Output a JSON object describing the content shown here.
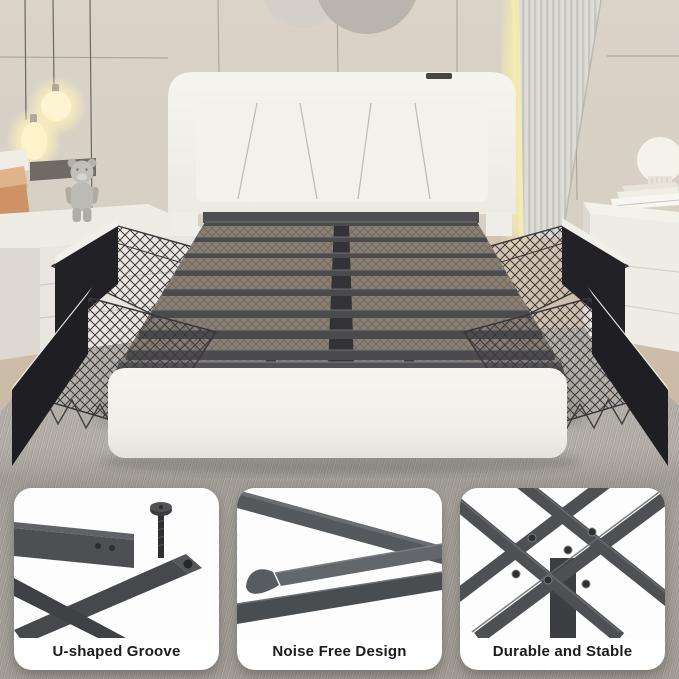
{
  "features": {
    "items": [
      {
        "label": "U-shaped Groove",
        "icon": "u-shaped-groove-detail"
      },
      {
        "label": "Noise Free Design",
        "icon": "noise-free-design-detail"
      },
      {
        "label": "Durable and Stable",
        "icon": "durable-and-stable-detail"
      }
    ]
  },
  "colors": {
    "wall": "#d8d1c6",
    "rug": "#b3afa8",
    "upholstery": "#f3f1ec",
    "metal_frame": "#4b4b4e",
    "led_accent": "#f6ecae",
    "card_background": "#ffffff",
    "caption_text": "#1c1c1e",
    "basket_wire": "#39373c",
    "drawer_front": "#222226",
    "wood_floor": "#cbbba7"
  }
}
